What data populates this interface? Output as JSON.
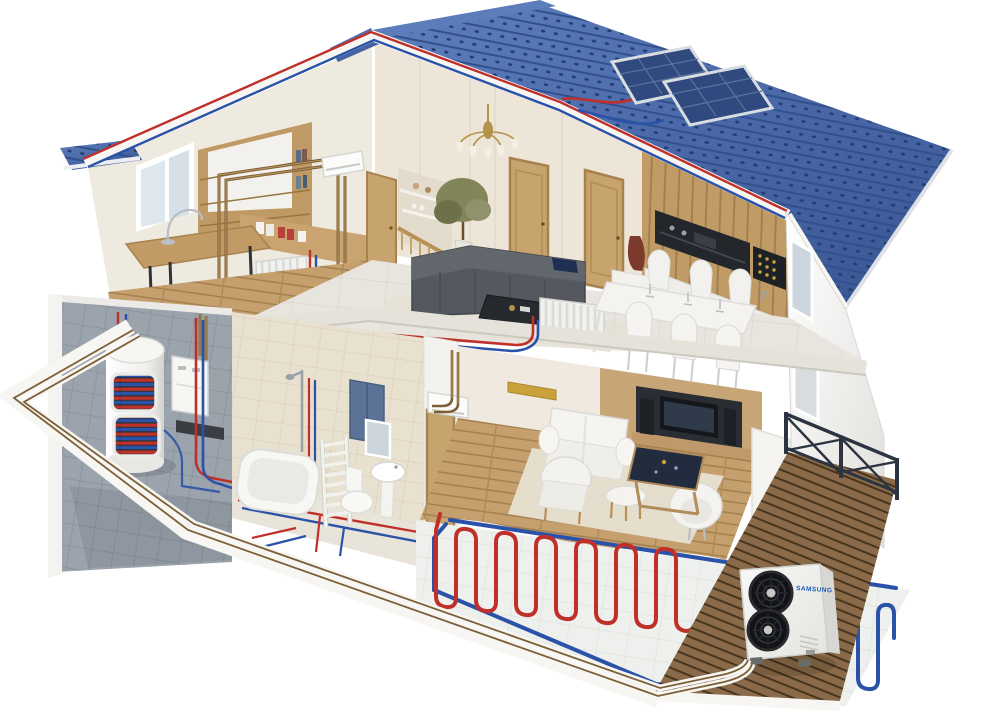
{
  "scene": {
    "title": "Cutaway 3D illustration of a two-storey house with an integrated heating system",
    "background": "#ffffff"
  },
  "labels": {
    "heat_pump_brand": "SAMSUNG"
  },
  "colors": {
    "bg": "#ffffff",
    "roof_blue": "#4a68a8",
    "roof_blue_light": "#5d7cba",
    "roof_blue_dark": "#3a5694",
    "roof_dot": "#1f3a6c",
    "pipe_red": "#c0302a",
    "pipe_blue": "#2a52a8",
    "pipe_copper": "#7d5f36",
    "pipe_copper_light": "#b9945f",
    "casing_white": "#f7f6f3",
    "wall_white": "#f4f3f0",
    "wall_cream": "#ece5d8",
    "wood_light": "#c5a06e",
    "wood_deck": "#8a6a48",
    "tile_gray": "#9ba3ad",
    "tile_beige": "#e9e1d0",
    "floor_marble": "#e8e5de",
    "sofa_gray": "#55595f",
    "radiator_white": "#f1f1ef",
    "fan_black": "#121316",
    "railing_dark": "#2b3440",
    "samsung_blue": "#1e5bb8",
    "cabinet_blue": "#5b7396",
    "art_gold": "#c9a23c",
    "vase_red": "#7c3a2c"
  },
  "components": {
    "roof": "blue tiled gable roof with cutaway edge carrying red/blue solar pipes",
    "solar_collectors": "two roof-mounted solar thermal panels",
    "storage_tank": "cylindrical hot-water tank with red/blue heating coils visible",
    "boiler": "wall-hung boiler unit in utility room",
    "radiators": "white column radiators on both floors",
    "towel_radiator": "ladder towel radiator in bathroom",
    "underfloor_heating": "red and blue serpentine floor-heating circuits",
    "wall_ac_units": "indoor wall-mounted fan-coil units",
    "heat_pump": "outdoor Samsung heat-pump unit with two fans on wooden deck",
    "terrace": "wooden deck with dark cross-braced railing",
    "pipework": "red flow, blue return and copper pipes linking all components"
  }
}
